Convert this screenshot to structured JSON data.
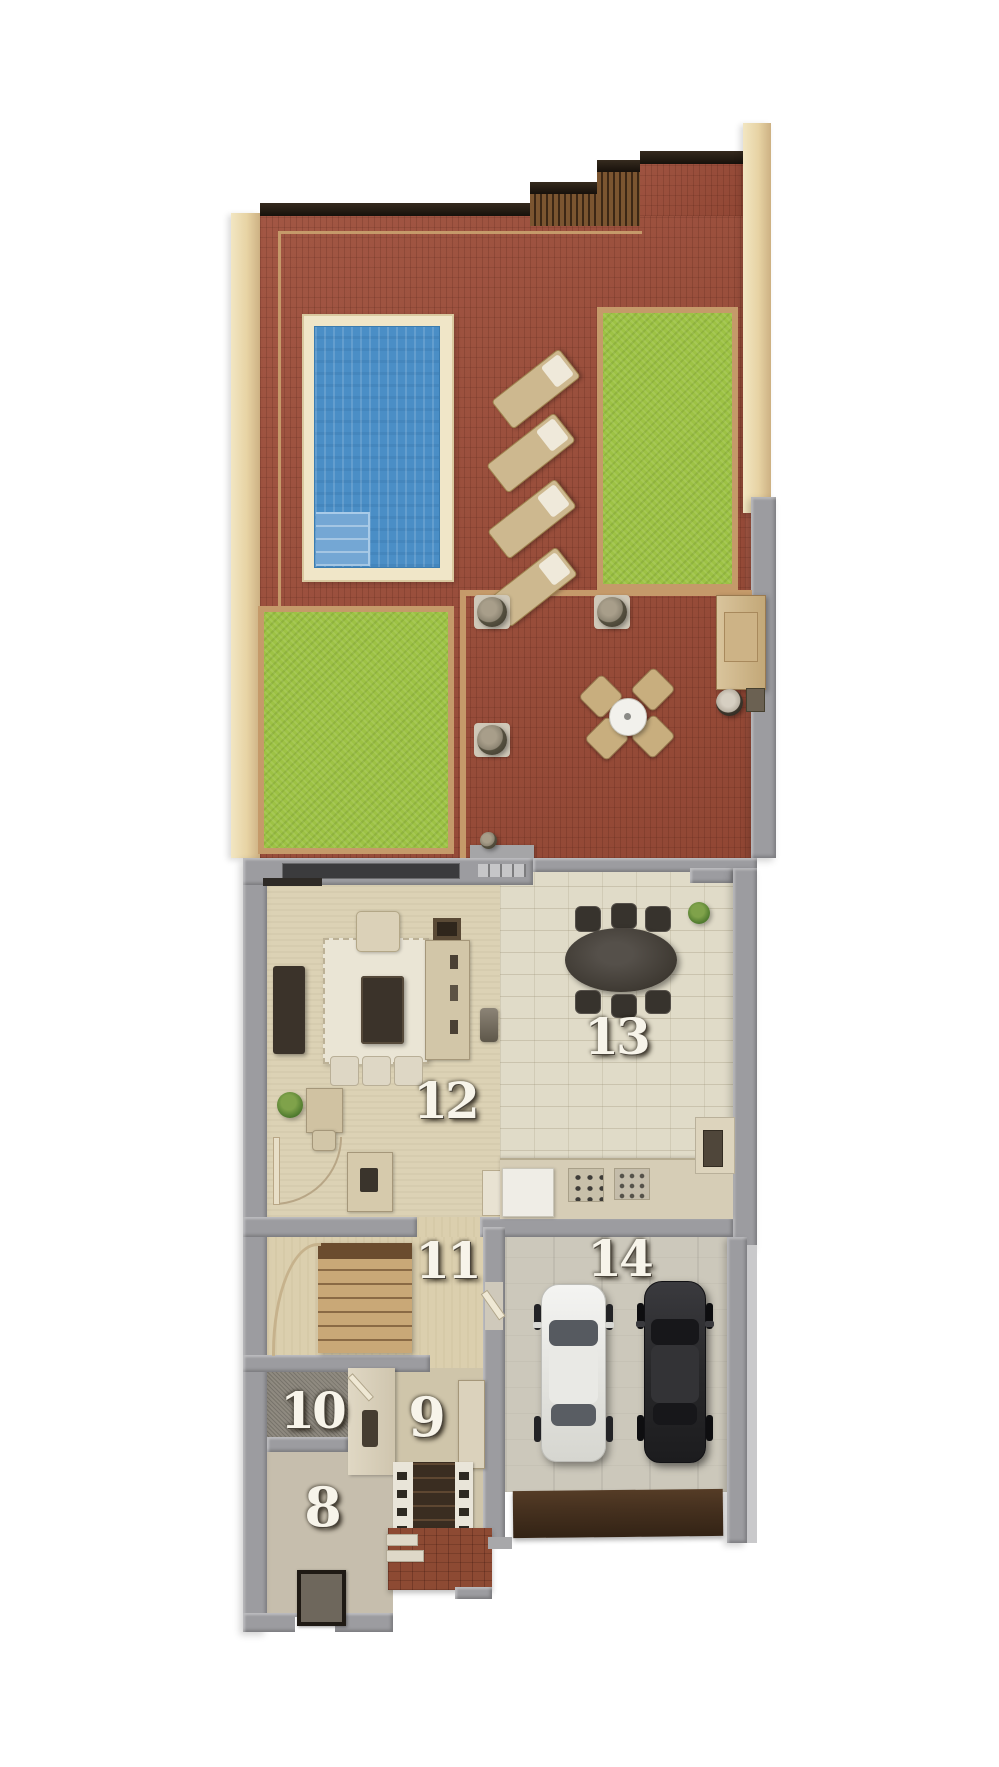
{
  "floorplan": {
    "rooms": {
      "r8": {
        "label": "8"
      },
      "r9": {
        "label": "9"
      },
      "r10": {
        "label": "10"
      },
      "r11": {
        "label": "11"
      },
      "r12": {
        "label": "12"
      },
      "r13": {
        "label": "13"
      },
      "r14": {
        "label": "14"
      }
    },
    "palette": {
      "terrace_brick": "#9c4c38",
      "grass": "#9dc244",
      "pool_water": "#4a8ec6",
      "pool_deck": "#f0e6c8",
      "cream_wall": "#e7d3a4",
      "gray_wall": "#9c9ca0",
      "railing_dark": "#241b13",
      "interior_carpet": "#dcd2b5",
      "interior_stone": "#e0dbc8",
      "garage_floor": "#ccc8bb",
      "garage_door": "#46311f",
      "porch_brick": "#8d4a33",
      "label_text": "#f7f4ea"
    }
  }
}
